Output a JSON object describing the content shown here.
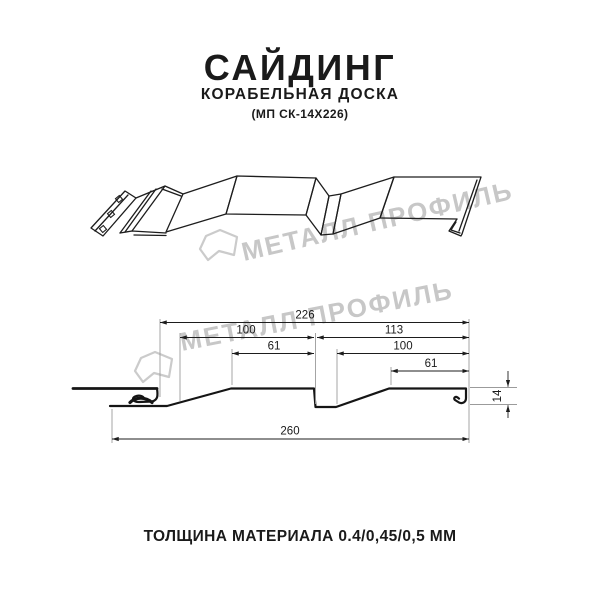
{
  "header": {
    "title": "САЙДИНГ",
    "subtitle": "КОРАБЕЛЬНАЯ ДОСКА",
    "model": "(МП СК-14Х226)"
  },
  "watermark": {
    "brand": "МЕТАЛЛ ПРОФИЛЬ",
    "color": "#c7c7c7"
  },
  "drawing": {
    "type": "siding panel profile cross-section",
    "dimensions": {
      "overall_top": "226",
      "left_upper": "100",
      "right_upper": "113",
      "left_inner": "61",
      "right_inner": "100",
      "right_small": "61",
      "overall_bottom": "260",
      "height": "14"
    }
  },
  "footer": {
    "thickness": "ТОЛЩИНА МАТЕРИАЛА 0.4/0,45/0,5 ММ"
  }
}
